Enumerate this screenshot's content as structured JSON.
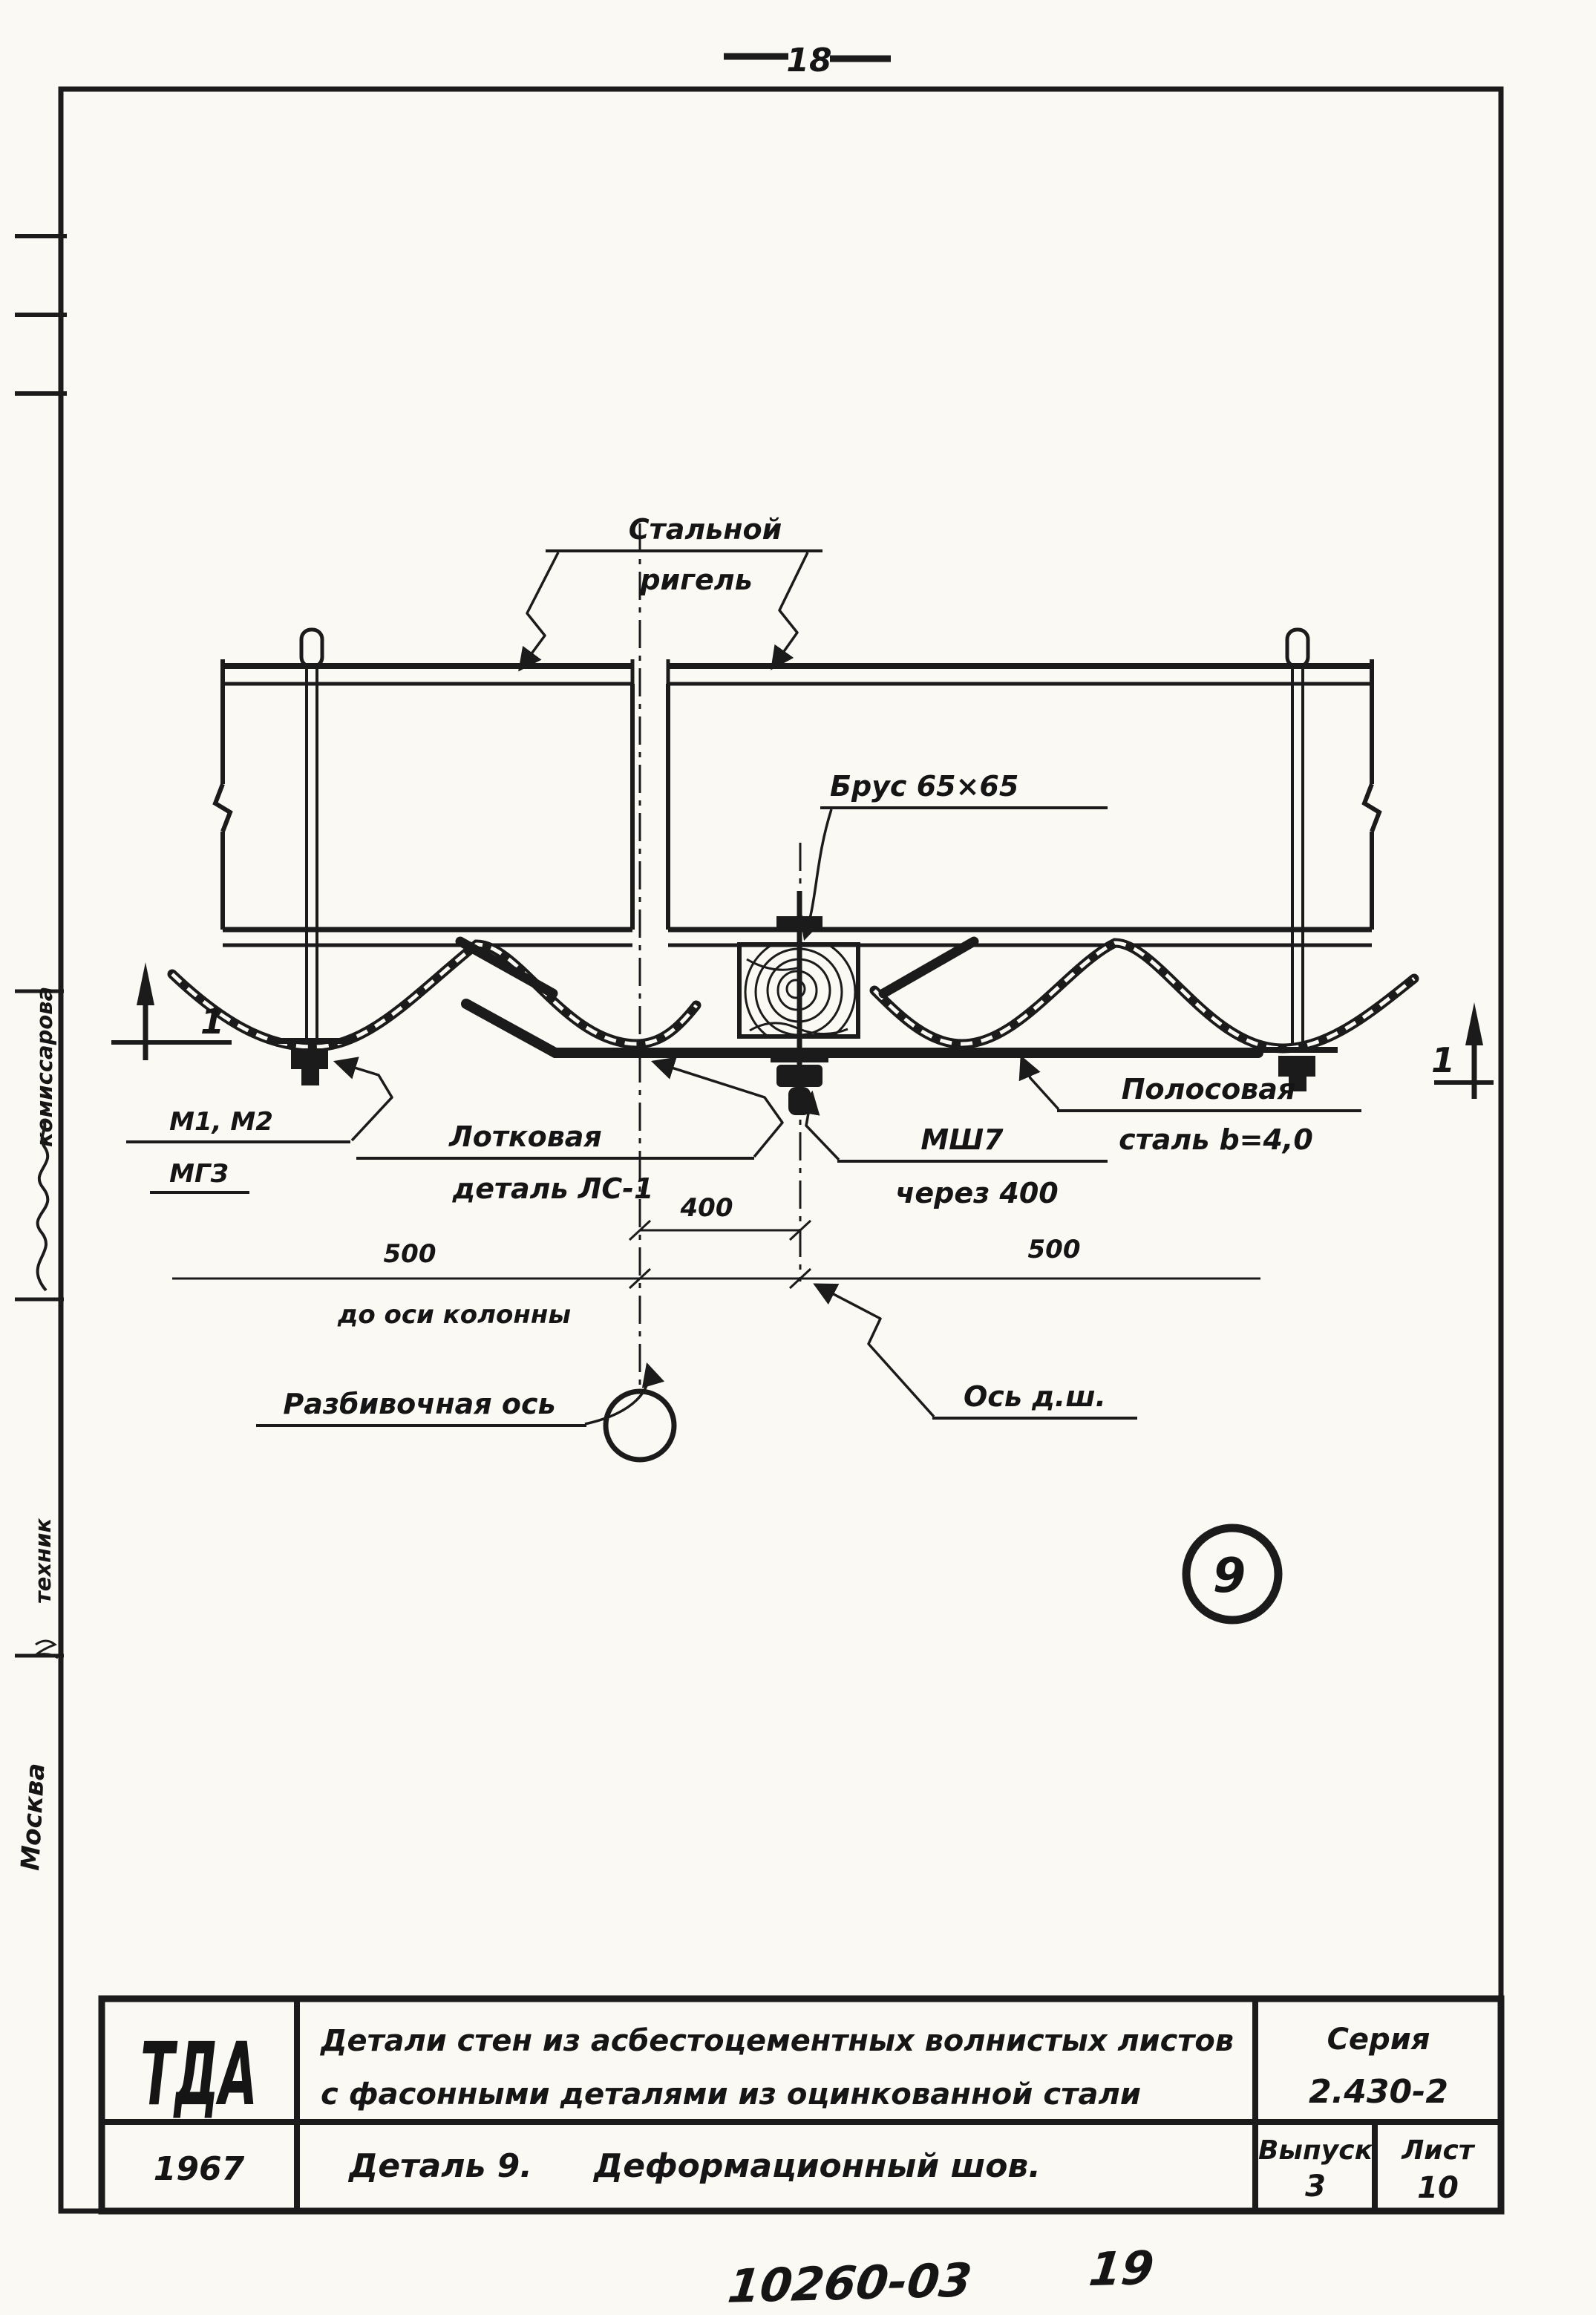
{
  "page": {
    "number": "18",
    "code": "10260-03",
    "code_sheet": "19"
  },
  "margin": {
    "examiner": "комиссарова",
    "role": "техник",
    "city": "Москва"
  },
  "drawing": {
    "labels": {
      "girder_line1": "Стальной",
      "girder_line2": "ригель",
      "bar": "Брус 65×65",
      "marks_line1": "М1, М2",
      "marks_line2": "МГЗ",
      "tray_line1": "Лотковая",
      "tray_line2": "деталь ЛС-1",
      "strip_line1": "Полосовая",
      "strip_line2": "сталь b=4,0",
      "seam_line1": "МШ7",
      "seam_line2": "через 400",
      "layout_axis": "Разбивочная ось",
      "joint_axis": "Ось д.ш.",
      "section_left": "1",
      "section_right": "1",
      "detail_badge": "9"
    },
    "dimensions": {
      "d400": "400",
      "d500_left": "500",
      "d500_right": "500",
      "to_column_axis": "до оси колонны"
    }
  },
  "title_block": {
    "logo": "ТДА",
    "year": "1967",
    "title_line1": "Детали стен из асбестоцементных волнистых листов",
    "title_line2": "с фасонными деталями из оцинкованной стали",
    "detail": "Деталь 9.",
    "detail_name": "Деформационный шов.",
    "series_label": "Серия",
    "series_value": "2.430-2",
    "issue_label": "Выпуск",
    "issue_value": "3",
    "sheet_label": "Лист",
    "sheet_value": "10"
  }
}
